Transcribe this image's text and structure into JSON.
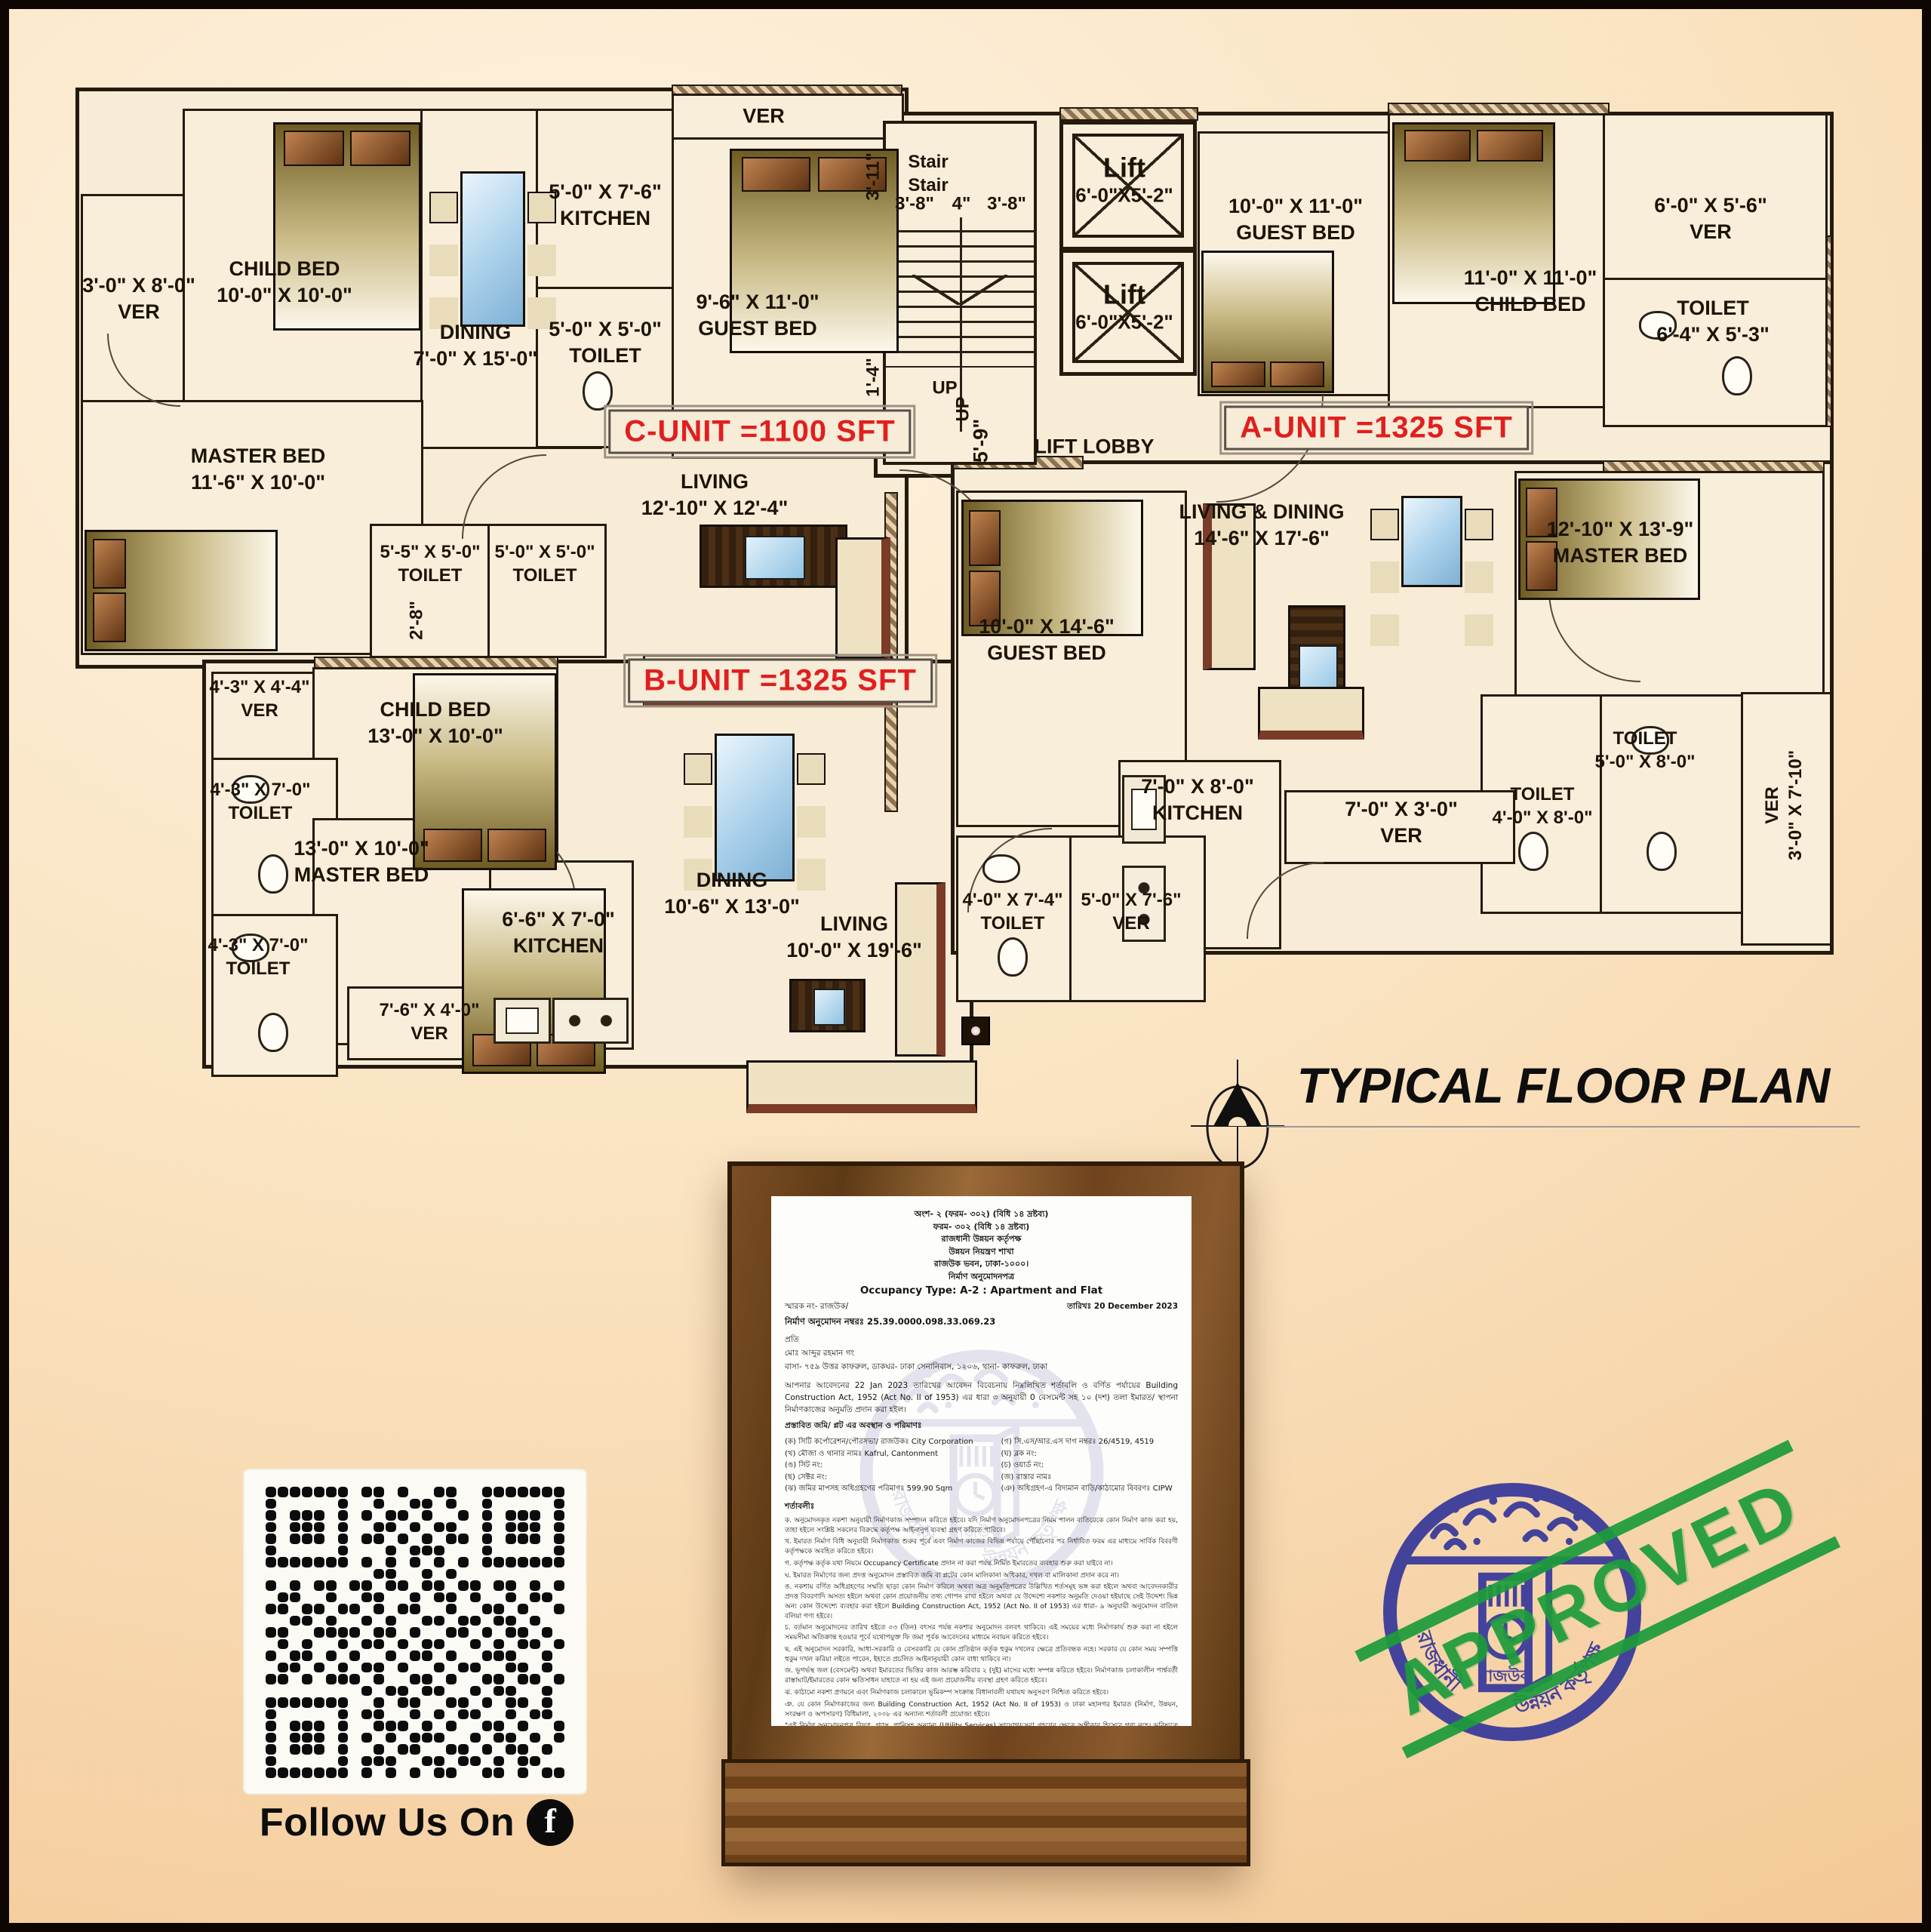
{
  "title": {
    "text": "TYPICAL FLOOR PLAN"
  },
  "plan": {
    "unit_labels": {
      "a": "A-UNIT =1325 SFT",
      "b": "B-UNIT =1325 SFT",
      "c": "C-UNIT =1100 SFT"
    },
    "core": {
      "stair1": "Stair",
      "stair2": "Stair",
      "dim_38a": "3'-8\"",
      "dim_4": "4\"",
      "dim_38b": "3'-8\"",
      "dim_311": "3'-11\"",
      "dim_14": "1'-4\"",
      "dim_28": "2'-8\"",
      "dim_59": "5'-9\"",
      "lift": "Lift",
      "lift_dim": "6'-0\"X5'-2\"",
      "up1": "UP",
      "up2": "UP",
      "lift_lobby": "LIFT LOBBY"
    },
    "rooms": [
      {
        "id": "ver-c",
        "l1": "3'-0\" X 8'-0\"",
        "l2": "VER"
      },
      {
        "id": "childbed-c",
        "l1": "CHILD BED",
        "l2": "10'-0\" X 10'-0\""
      },
      {
        "id": "dining-c",
        "l1": "DINING",
        "l2": "7'-0\" X 15'-0\""
      },
      {
        "id": "kitchen-c",
        "l1": "5'-0\" X 7'-6\"",
        "l2": "KITCHEN"
      },
      {
        "id": "toilet-c",
        "l1": "5'-0\" X 5'-0\"",
        "l2": "TOILET"
      },
      {
        "id": "masterbed-c",
        "l1": "MASTER BED",
        "l2": "11'-6\" X 10'-0\""
      },
      {
        "id": "toilet-c1",
        "l1": "5'-5\" X 5'-0\"",
        "l2": "TOILET"
      },
      {
        "id": "toilet-c2",
        "l1": "5'-0\" X 5'-0\"",
        "l2": "TOILET"
      },
      {
        "id": "ver-topc",
        "l1": "VER",
        "l2": ""
      },
      {
        "id": "guestbed-c",
        "l1": "9'-6\" X 11'-0\"",
        "l2": "GUEST BED"
      },
      {
        "id": "living-c",
        "l1": "LIVING",
        "l2": "12'-10\" X 12'-4\""
      },
      {
        "id": "guestbed-a",
        "l1": "10'-0\" X 11'-0\"",
        "l2": "GUEST BED"
      },
      {
        "id": "childbed-a",
        "l1": "11'-0\" X 11'-0\"",
        "l2": "CHILD BED"
      },
      {
        "id": "ver-a",
        "l1": "6'-0\" X 5'-6\"",
        "l2": "VER"
      },
      {
        "id": "toilet-a",
        "l1": "TOILET",
        "l2": "6'-4\" X 5'-3\""
      },
      {
        "id": "livdin-a",
        "l1": "LIVING & DINING",
        "l2": "14'-6\" X 17'-6\""
      },
      {
        "id": "guestbed-b",
        "l1": "10'-0\" X 14'-6\"",
        "l2": "GUEST BED"
      },
      {
        "id": "masterbed-a",
        "l1": "12'-10\" X 13'-9\"",
        "l2": "MASTER BED"
      },
      {
        "id": "toilet-a1",
        "l1": "TOILET",
        "l2": "5'-0\" X 8'-0\""
      },
      {
        "id": "toilet-a2",
        "l1": "TOILET",
        "l2": "4'-0\" X 8'-0\""
      },
      {
        "id": "ver-ar",
        "l1": "VER",
        "l2": "3'-0\" X 7'-10\""
      },
      {
        "id": "kitchen-a",
        "l1": "7'-0\" X 8'-0\"",
        "l2": "KITCHEN"
      },
      {
        "id": "ver-am",
        "l1": "7'-0\" X 3'-0\"",
        "l2": "VER"
      },
      {
        "id": "toilet-b",
        "l1": "4'-0\" X 7'-4\"",
        "l2": "TOILET"
      },
      {
        "id": "ver-b",
        "l1": "5'-0\" X 7'-6\"",
        "l2": "VER"
      },
      {
        "id": "ver-bl",
        "l1": "4'-3\" X 4'-4\"",
        "l2": "VER"
      },
      {
        "id": "childbed-b",
        "l1": "CHILD BED",
        "l2": "13'-0\" X 10'-0\""
      },
      {
        "id": "toilet-bl1",
        "l1": "4'-3\" X 7'-0\"",
        "l2": "TOILET"
      },
      {
        "id": "masterbed-b",
        "l1": "13'-0\" X 10'-0\"",
        "l2": "MASTER BED"
      },
      {
        "id": "toilet-bl2",
        "l1": "4'-3\" X 7'-0\"",
        "l2": "TOILET"
      },
      {
        "id": "kitchen-b",
        "l1": "6'-6\" X 7'-0\"",
        "l2": "KITCHEN"
      },
      {
        "id": "ver-bb",
        "l1": "7'-6\" X 4'-0\"",
        "l2": "VER"
      },
      {
        "id": "dining-b",
        "l1": "DINING",
        "l2": "10'-6\" X 13'-0\""
      },
      {
        "id": "living-b",
        "l1": "LIVING",
        "l2": "10'-0\" X 19'-6\""
      }
    ]
  },
  "certificate": {
    "header_lines": [
      "অংশ- ২ (ফরম- ৩০২) (বিধি ১৪ দ্রষ্টব্য)",
      "ফরম- ৩০২ (বিধি ১৪ দ্রষ্টব্য)",
      "রাজধানী উন্নয়ন কর্তৃপক্ষ",
      "উন্নয়ন নিয়ন্ত্রণ শাখা",
      "রাজউক ভবন, ঢাকা-১০০০।",
      "নির্মাণ অনুমোদনপত্র"
    ],
    "occupancy": "Occupancy Type: A-2 : Apartment and Flat",
    "memo": "স্মারক নং- রাজউক/",
    "date": "তারিখঃ 20 December 2023",
    "approval_no": "নির্মাণ অনুমোদন নম্বরঃ 25.39.0000.098.33.069.23",
    "to": "প্রতি",
    "addressee1": "মোঃ আব্দুর রহমান গং",
    "addressee2": "বাসা- ৭৫৯ উত্তর কাফরুল, ডাকঘর- ঢাকা সেনানিবাস, ১২০৬, থানা- কাফরুল, ঢাকা",
    "body": "আপনার আবেদনের 22 Jan 2023 তারিখের আবেদন বিবেচনায় নিম্নলিখিত শর্তাবলি ও বর্ণিত পর্যায়ের Building Construction Act, 1952 (Act No. II of 1953) এর ধারা ৩ অনুযায়ী 0 বেসমেন্ট সহ ১০ (দশ) তলা ইমারত/ স্থাপনা নির্মাণকাজের অনুমতি প্রদান করা হইল।",
    "plot_heading": "প্রস্তাবিত জমি/ প্লট এর অবস্থান ও পরিমাণঃ",
    "plot_rows": [
      [
        "(ক) সিটি কর্পোরেশন/পৌরসভা/ রাজউকঃ City Corporation",
        "(গ) সি.এস/আর.এস দাগ নম্বরঃ 26/4519, 4519"
      ],
      [
        "(খ) মৌজা ও থানার নামঃ Kafrul, Cantonment",
        "(ঘ) ব্লক নং:"
      ],
      [
        "(ঙ) সিট নং:",
        "(চ) ওয়ার্ড নং:"
      ],
      [
        "(ছ) সেক্টর নং:",
        "(জ) রাস্তার নামঃ"
      ],
      [
        "(ঝ) জমির মাপসহ অধিগ্রহণের পরিমাণঃ 599.90 Sqm",
        "(ঞ) অধিগ্রহণ-এ বিদ্যমান বাড়ি/কাঠামোর বিবরণঃ CIPW"
      ]
    ],
    "conditions_heading": "শর্তাবলীঃ",
    "conditions": [
      "ক. অনুমোদনকৃত নকশা অনুযায়ী নির্মাণকাজ সম্পাদন করিতে হইবে। যদি নির্মাণ অনুমোদনপত্রের নিয়ম পালন ব্যতিরেকে কোন নির্মাণ কাজ করা হয়, তাহা হইলে সংশ্লিষ্ট সকলের বিরুদ্ধে কর্তৃপক্ষ আইনানুগ ব্যবস্থা গ্রহণ করিতে পারিবে।",
      "খ. ইমারত নির্মাণ বিধি অনুযায়ী নির্মাণকাজ শুরুর পূর্বে এবং নির্মাণ কাজের বিভিন্ন পর্যায়ে পৌঁছানোর পর নির্ধারিত ফরম এর মাধ্যমে সার্বিক বিবরণী কর্তৃপক্ষকে অবহিত করিতে হইবে।",
      "গ. কর্তৃপক্ষ কর্তৃক যথা নিয়মে Occupancy Certificate প্রদান না করা পর্যন্ত নির্মিত ইমারতের ব্যবহার শুরু করা যাইবে না।",
      "ঘ. ইমারত নির্মাণের জন্য প্রদত্ত অনুমোদন প্রস্তাবিত জমি বা প্লটের কোন মালিকানা অধিকার, দখল বা মালিকানা প্রদান করে না।",
      "ঙ. নকশায় বর্ণিত অধিগ্রহণের সম্মতি ছাড়া কোন নির্মাণ করিলে অথবা অত্র অনুমতিপত্রের উল্লিখিত শর্তসমূহ ভঙ্গ করা হইলে অথবা আবেদনকারীর প্রদত্ত বিবরণাদি অসত্য হইলে অথবা কোন প্রয়োজনীয় তথ্য গোপন রাখা হইলে অথবা যে উদ্দেশ্যে নকশার অনুমতি দেওয়া হইয়াছে সেই উদ্দেশ্য ভিন্ন অন্য কোন উদ্দেশ্যে ব্যবহার করা হইলে Building Construction Act, 1952 (Act No. II of 1953) এর ধারা- ৯ অনুযায়ী অনুমোদন বাতিল বলিয়া গণ্য হইবে।",
      "চ. বর্তমান অনুমোদনের তারিখ হইতে ০৩ (তিন) বৎসর পর্যন্ত নকশার অনুমোদন বলবৎ থাকিবে। এই সময়ের মধ্যে নির্মাণকার্য শুরু করা না হইলে সময়সীমা অতিক্রান্ত হওয়ার পূর্বে যথোপযুক্ত ফি জমা পূর্বক আবেদনের মাধ্যমে নবায়ন করিতে হইবে।",
      "ছ. এই অনুমোদন সরকারি, আধা-সরকারি ও বেসরকারি যে কোন প্রতিষ্ঠান কর্তৃক হুকুম দখলের ক্ষেত্রে প্রতিবন্ধক নহে। সরকার যে কোন সময় সম্পত্তি হুকুম দখল করিয়া লইতে পারেন, ইহাতে প্রচলিত আইনানুযায়ী কোন বাধা থাকিবে না।",
      "জ. ভূগর্ভস্থ জল (বেসমেন্ট) অথবা ইমারতের ভিত্তির কাজ আরম্ভ করিবার ২ (দুই) মাসের মধ্যে সম্পন্ন করিতে হইবে। নির্মাণকাজ চলাকালীন পার্শ্ববর্তী রাস্তাঘাট/ইমারতের কোন ক্ষতিসাধন যাহাতে না হয় এই জন্য প্রয়োজনীয় ব্যবস্থা গ্রহণ করিতে হইবে।",
      "ঝ. কাঠামো নকশা প্রণয়নে এবং নির্মাণকাজ চলাকালে ভূমিকম্প সংক্রান্ত বিধানাবলী যথাযথ অনুসরণ নিশ্চিত করিতে হইবে।",
      "ঞ. যে কোন নির্মাণকাজের জন্য Building Construction Act, 1952 (Act No. II of 1953) ও ঢাকা মহানগর ইমারত (নির্মাণ, উন্নয়ন, সংরক্ষণ ও অপসারণ) বিধিমালা, ২০০৮ এর অন্যান্য শর্তাবলী প্রযোজ্য হইবে।"
    ],
    "footnote": "\"এই নির্মাণ অনুমোদনপত্র বিদ্যুৎ, গ্যাস, পানিসহ অন্যান্য (Utility Services) সংযোগ/সেবা গ্রহণের ক্ষেত্রে অঙ্গীকার হিসেবে গণ্য নহে। ভবিষ্যতে ভবনের অনুমোদিত নকশার ব্যত্যয় ঘটাইয়া বিদ্যুৎ, গ্যাস, পানিসহ অন্যান্য (Utility Services) সংযোগ/সেবা গ্রহণের ক্ষেত্রে অনুমোদনকারী অফিসার কর্তৃক প্রদত্ত ৩০০ ফরম এ Occupancy Certificate (ব্যবহার বা বসবাস সনদপত্র) গ্রহণ পূর্বক আনুষঙ্গিকভাবে হিসেবে লেখা প্রমাণপত্রসহ দাখিল করিতে হইবে।\" প্রতি কার্যার্থে একটি করে মুদ্রণকপি সংরক্ষণ করতে হবে।",
    "final_line": "০১ (এক) টি  ১০ (দশ) তলা আবাসিক (Apartment and Flat) টাইপ ইমারতের যে অফিস নকশা বিসি কমিটি সভার \"ক\" ৩/১ এর ১৯/১২/২০২৩ তারিখের সভায় সর্বসম্মতিক্রমে অনুমোদিত।"
  },
  "qr": {
    "caption": "Follow Us On",
    "platform": "facebook",
    "platform_glyph": "f",
    "matrix": [
      "1111111011010011001111111",
      "1000001001001101001000001",
      "1011101010110100101011101",
      "1011101001101011001011101",
      "1011101011010101101011101",
      "1000001000101110001000001",
      "1111111010101010101111111",
      "0000000001100101000000000",
      "1010110110110110110110101",
      "0110010011001011010010110",
      "1101101101011001001101001",
      "0011010010100110110110100",
      "1100111101101001101011010",
      "0101001011010110010101101",
      "1011010100101101001110010",
      "0110101011010010110011010",
      "1101011101001101001101101",
      "0000000010110110010110010",
      "1111111001011001101011010",
      "1000001011001010110010110",
      "1011101001110101001101001",
      "1011101010101110010110101",
      "1011101001011001101011010",
      "1000001011100110110101100",
      "1111111010101011001101011"
    ]
  },
  "stamp": {
    "approved": "APPROVED",
    "org_bn": "রাজউক",
    "ring_left_bn": "রাজধানী",
    "ring_right_bn": "উন্নয়ন কর্তৃপক্ষ",
    "blue": "#3b3c9b",
    "green": "#1d9c3c"
  }
}
